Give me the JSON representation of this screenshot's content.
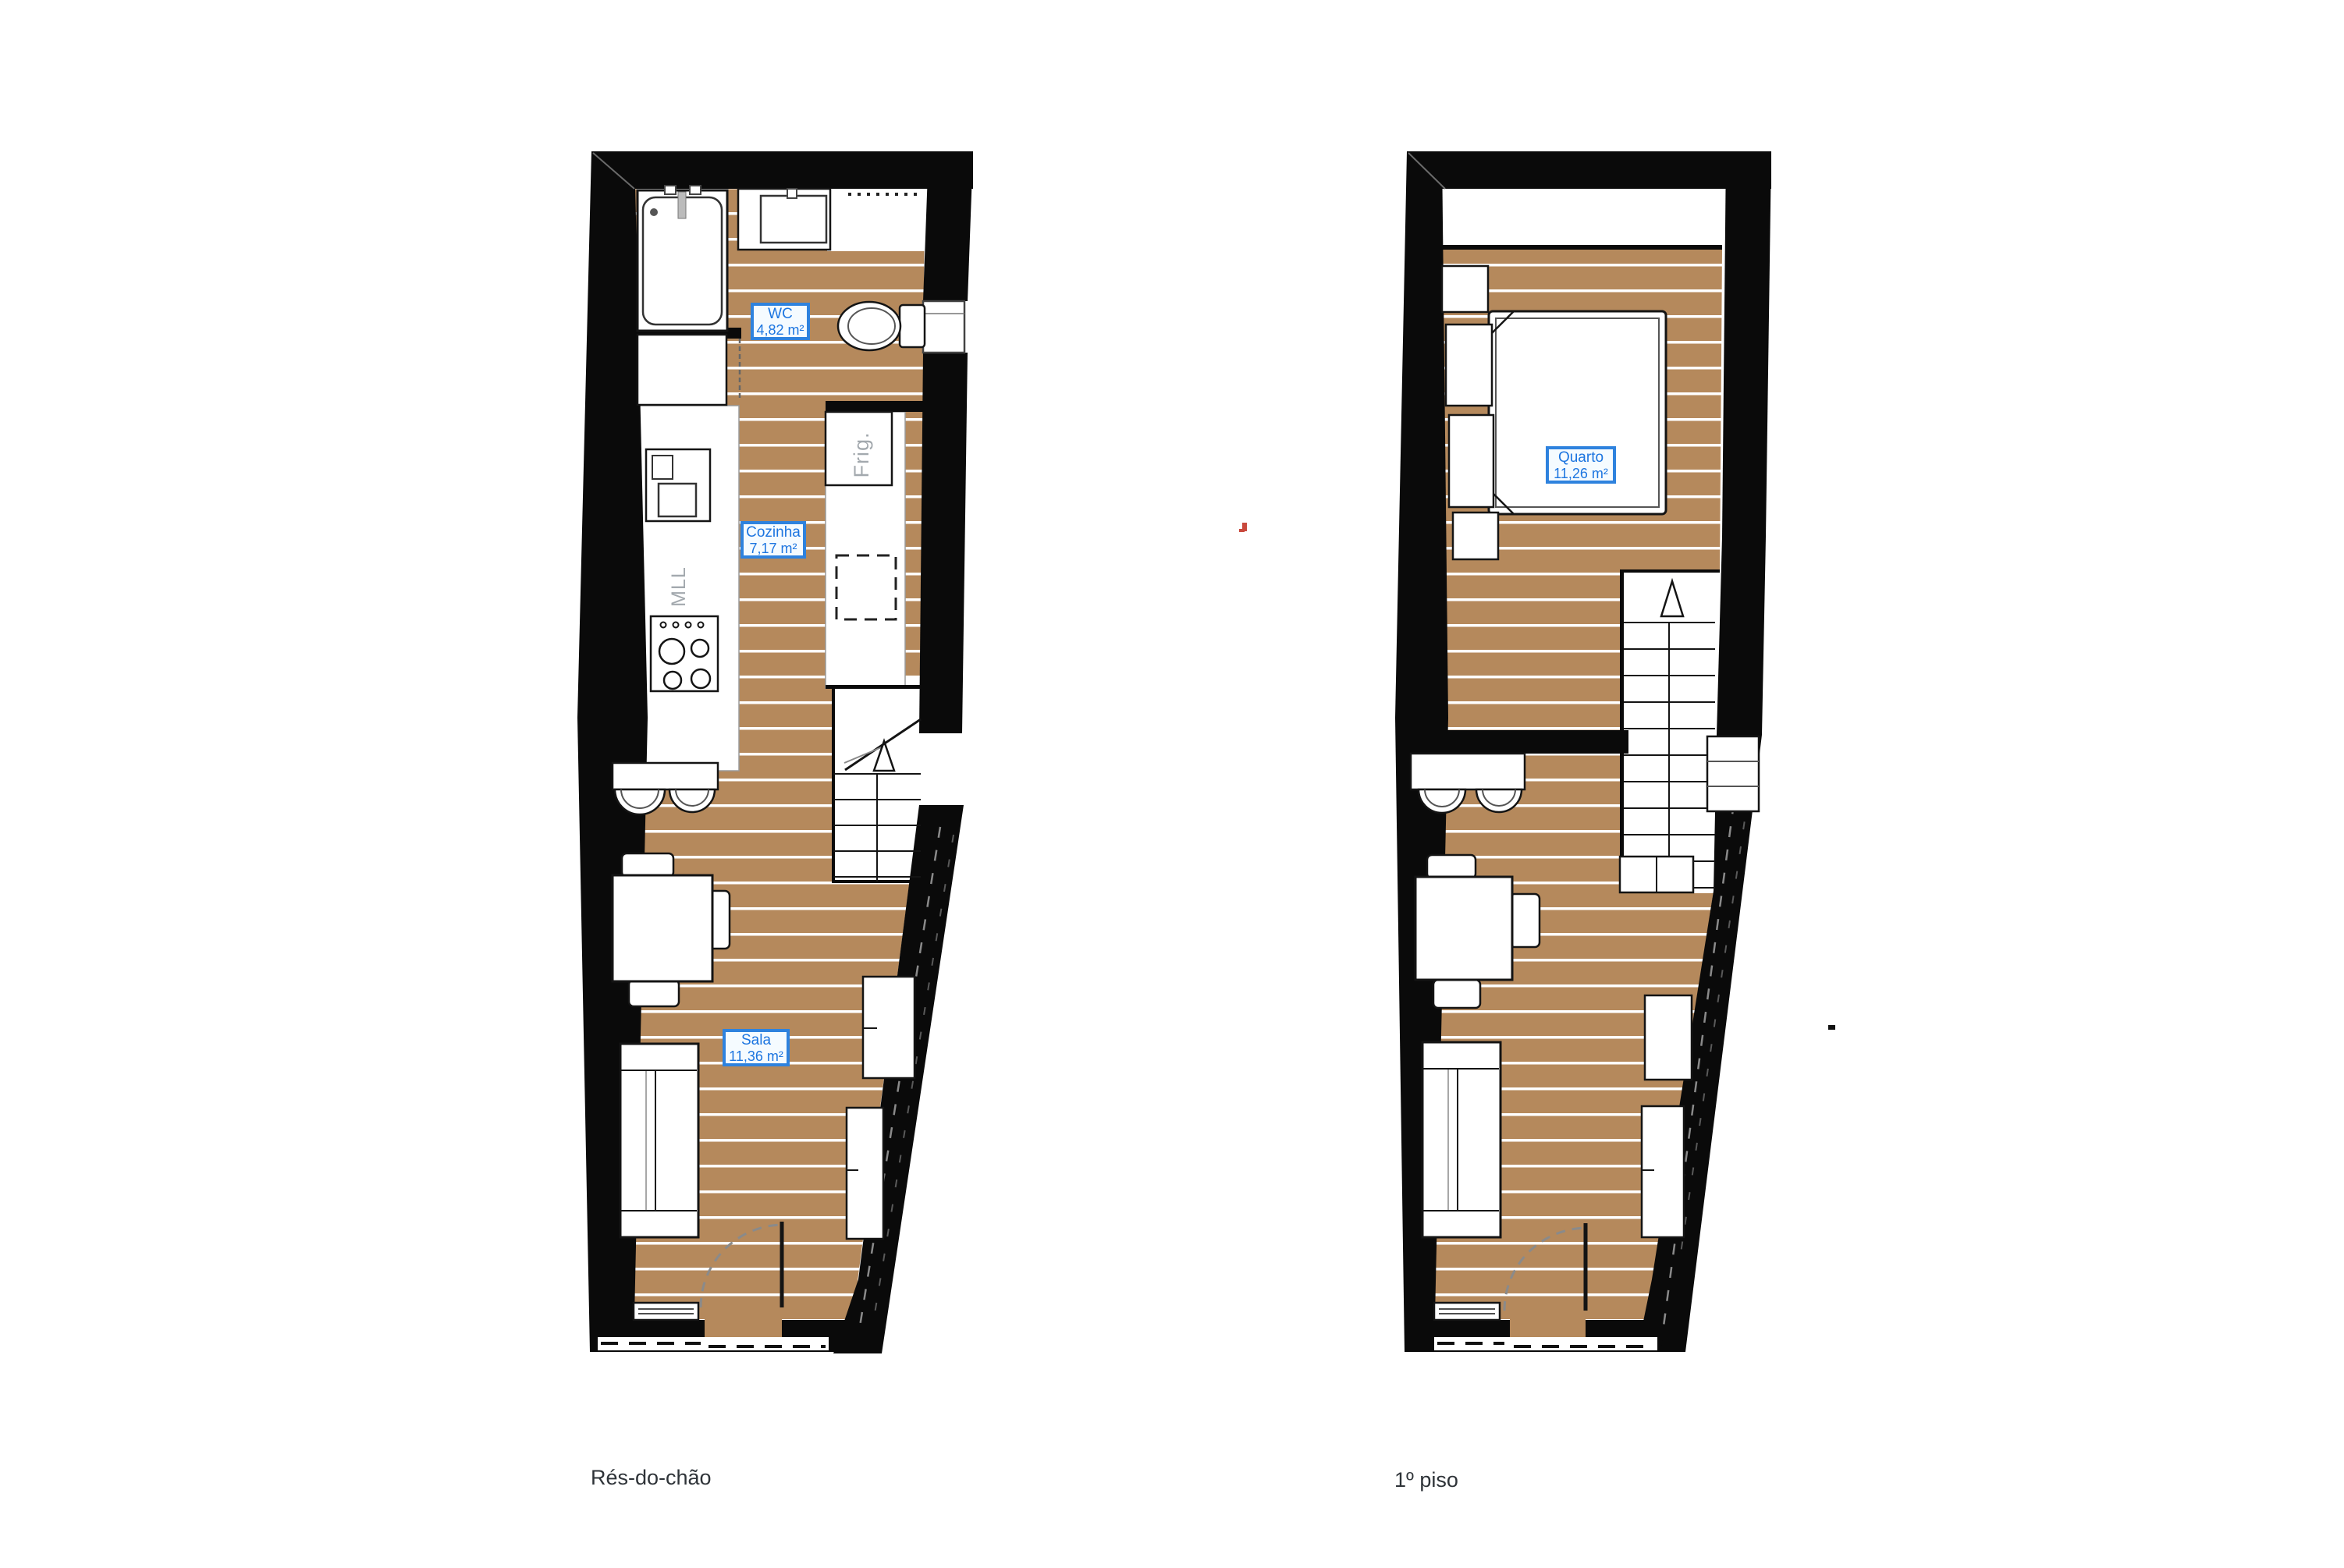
{
  "page": {
    "background": "#ffffff",
    "type": "architectural floor plan"
  },
  "colors": {
    "wall": "#0a0a0a",
    "floor": "#b5895c",
    "plank_line": "#ffffff",
    "label_border": "#2e82de",
    "label_text": "#1c75e0",
    "label_background": "#f5fbff",
    "appliance_text": "#a3a9ae",
    "caption_text": "#2e3338",
    "artifact_red": "#c9493d"
  },
  "floors": [
    {
      "caption": "Rés-do-chão",
      "rooms": [
        {
          "name": "WC",
          "area": "4,82 m²"
        },
        {
          "name": "Cozinha",
          "area": "7,17 m²"
        },
        {
          "name": "Sala",
          "area": "11,36 m²"
        }
      ],
      "appliances": {
        "fridge": "Frig.",
        "dishwasher": "MLL"
      }
    },
    {
      "caption": "1º piso",
      "rooms": [
        {
          "name": "Quarto",
          "area": "11,26 m²"
        }
      ]
    }
  ]
}
